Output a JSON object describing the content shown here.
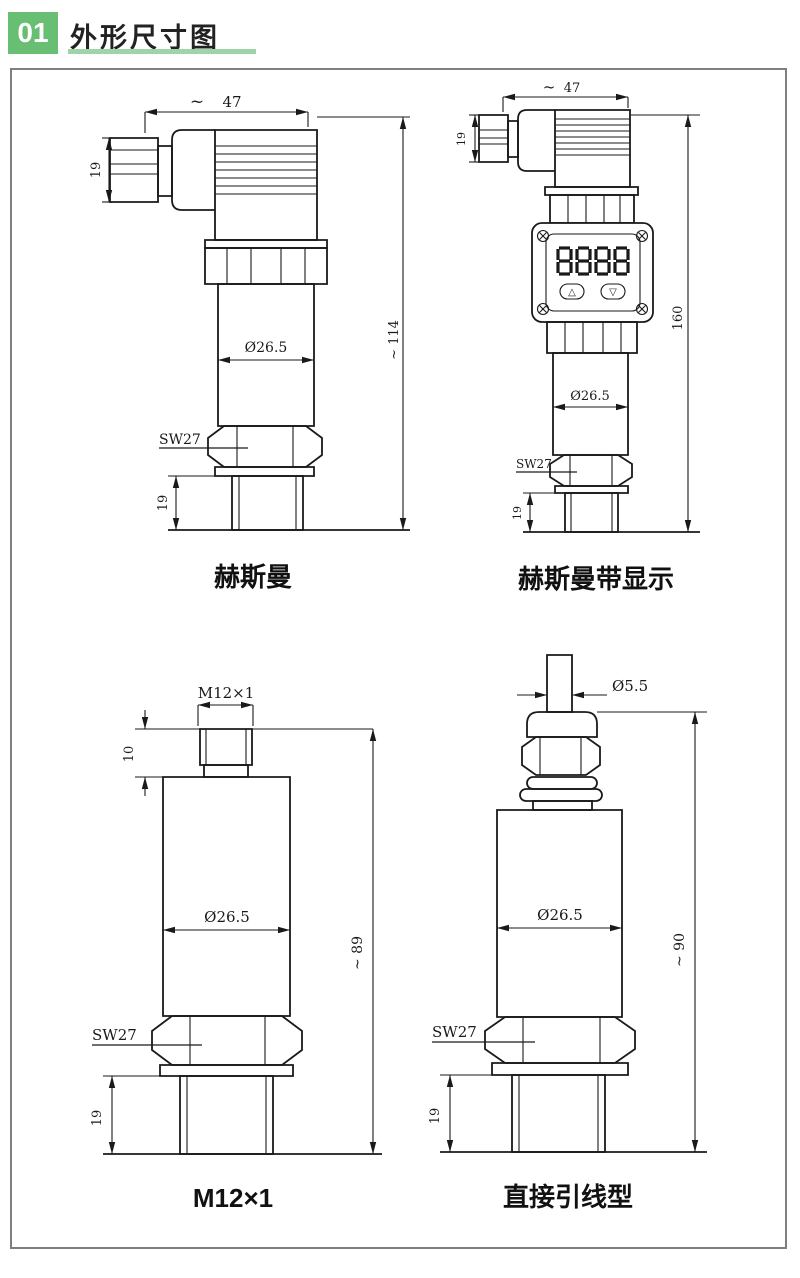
{
  "header": {
    "number": "01",
    "title": "外形尺寸图"
  },
  "accent": {
    "green": "#68bf73",
    "green_light": "#9fd4a8",
    "line": "#1a1a1a",
    "box_border": "#7f7f7f"
  },
  "drawings": {
    "d1": {
      "label": "赫斯曼",
      "approx": "~",
      "width": "47",
      "connector_height": "19",
      "diameter": "Ø26.5",
      "total_height": "~ 114",
      "wrench": "SW27",
      "thread_length": "19"
    },
    "d2": {
      "label": "赫斯曼带显示",
      "approx": "~",
      "width": "47",
      "connector_height": "19",
      "diameter": "Ø26.5",
      "total_height": "160",
      "wrench": "SW27",
      "thread_length": "19",
      "display_digits": "8888",
      "button_up": "△",
      "button_down": "▽"
    },
    "d3": {
      "label": "M12×1",
      "thread_spec": "M12×1",
      "connector_height": "10",
      "diameter": "Ø26.5",
      "total_height": "~ 89",
      "wrench": "SW27",
      "thread_length": "19"
    },
    "d4": {
      "label": "直接引线型",
      "cable_diameter": "Ø5.5",
      "diameter": "Ø26.5",
      "total_height": "~ 90",
      "wrench": "SW27",
      "thread_length": "19"
    }
  }
}
